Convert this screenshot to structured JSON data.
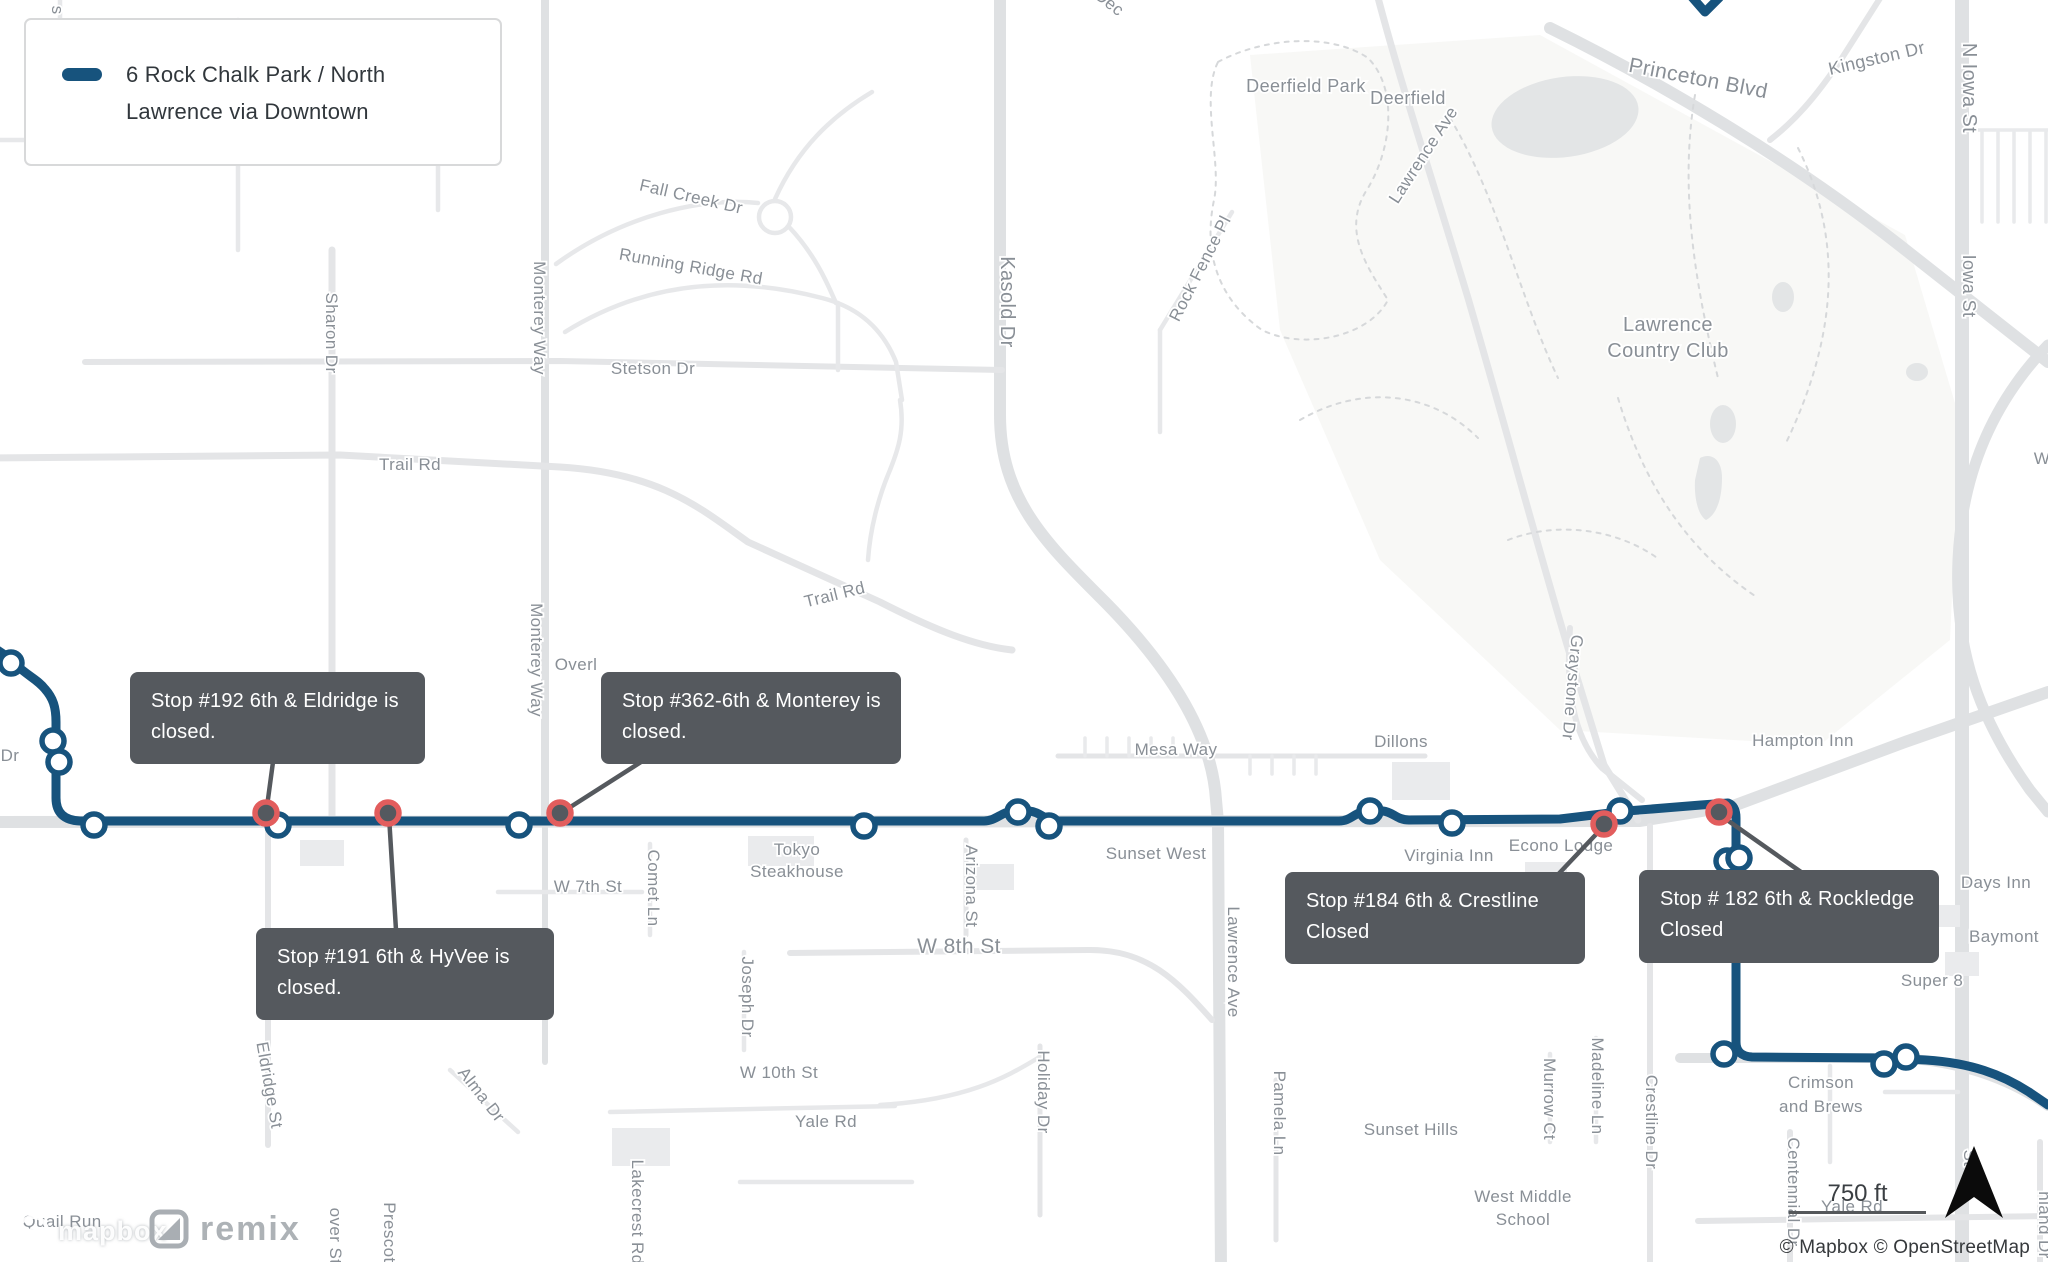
{
  "legend": {
    "line1": "6 Rock Chalk Park / North",
    "line2": "Lawrence via Downtown",
    "route_color": "#17537d"
  },
  "tooltips": [
    {
      "id": "stop-192",
      "line1": "Stop #192 6th & Eldridge is",
      "line2": "closed.",
      "leader": [
        266,
        814,
        273,
        762
      ]
    },
    {
      "id": "stop-362",
      "line1": "Stop #362-6th & Monterey is",
      "line2": "closed.",
      "leader": [
        561,
        813,
        641,
        762
      ]
    },
    {
      "id": "stop-191",
      "line1": "Stop #191 6th & HyVee is",
      "line2": "closed.",
      "leader": [
        389,
        816,
        396,
        930
      ]
    },
    {
      "id": "stop-184",
      "line1": "Stop #184 6th & Crestline",
      "line2": "Closed",
      "leader": [
        1603,
        827,
        1549,
        884
      ]
    },
    {
      "id": "stop-182",
      "line1": "Stop # 182 6th & Rockledge",
      "line2": "Closed",
      "leader": [
        1720,
        815,
        1801,
        872
      ]
    }
  ],
  "route": {
    "color": "#17537d",
    "width": 9,
    "main_path": "M -6,648 C 4,654 9,658 14,663 C 29,677 37,679 45,689 C 53,698 56,707 56,722 L 56,798 Q 56,820 80,821 L 984,821 C 996,821 1001,812 1013,811 L 1029,811 C 1041,812 1045,821 1057,821 L 1339,821 C 1351,821 1355,812 1366,811 L 1383,811 C 1393,812 1397,820 1409,820 L 1560,819 L 1627,811 L 1701,805 L 1728,803 Q 1736,806 1736,818 L 1736,1042 Q 1736,1056 1752,1057 L 1884,1058 L 1926,1060 C 1971,1063 2001,1074 2029,1092 L 2048,1105",
    "north_stub_path": "M 1691,-4 L 1705,12 L 1719,-2"
  },
  "stops": {
    "open_style": {
      "fill": "#ffffff",
      "stroke": "#17537d"
    },
    "closed_style": {
      "fill": "#54595f",
      "stroke": "#e25d5d"
    },
    "open": [
      [
        11,
        663
      ],
      [
        53,
        741
      ],
      [
        59,
        762
      ],
      [
        94,
        825
      ],
      [
        278,
        825
      ],
      [
        519,
        825
      ],
      [
        864,
        826
      ],
      [
        1018,
        812
      ],
      [
        1049,
        826
      ],
      [
        1370,
        811
      ],
      [
        1452,
        823
      ],
      [
        1620,
        811
      ],
      [
        1727,
        861
      ],
      [
        1739,
        858
      ],
      [
        1724,
        1054
      ],
      [
        1884,
        1064
      ],
      [
        1906,
        1057
      ]
    ],
    "closed": [
      [
        266,
        813
      ],
      [
        388,
        813
      ],
      [
        560,
        813
      ],
      [
        1604,
        824
      ],
      [
        1719,
        812
      ]
    ]
  },
  "map_labels": [
    {
      "text": "s F",
      "x": 52,
      "y": 18,
      "r": 90,
      "s": 17
    },
    {
      "text": "Dec",
      "x": 1106,
      "y": 7,
      "r": 38,
      "s": 17
    },
    {
      "text": "Sharon Dr",
      "x": 326,
      "y": 333,
      "r": 90,
      "s": 17
    },
    {
      "text": "Monterey Way",
      "x": 534,
      "y": 318,
      "r": 90,
      "s": 17
    },
    {
      "text": "Monterey Way",
      "x": 531,
      "y": 660,
      "r": 90,
      "s": 17
    },
    {
      "text": "Fall Creek Dr",
      "x": 690,
      "y": 202,
      "r": 13,
      "s": 17
    },
    {
      "text": "Running Ridge Rd",
      "x": 690,
      "y": 272,
      "r": 10,
      "s": 17
    },
    {
      "text": "Stetson Dr",
      "x": 653,
      "y": 374,
      "r": 0,
      "s": 17
    },
    {
      "text": "Trail Rd",
      "x": 410,
      "y": 470,
      "r": 0,
      "s": 17
    },
    {
      "text": "Trail Rd",
      "x": 836,
      "y": 600,
      "r": -14,
      "s": 17
    },
    {
      "text": "Kasold Dr",
      "x": 1001,
      "y": 302,
      "r": 90,
      "s": 20
    },
    {
      "text": "Rock Fence Pl",
      "x": 1205,
      "y": 271,
      "r": -63,
      "s": 17
    },
    {
      "text": "Deerfield Park",
      "x": 1306,
      "y": 92,
      "r": 0,
      "s": 18
    },
    {
      "text": "Deerfield",
      "x": 1408,
      "y": 104,
      "r": 0,
      "s": 18
    },
    {
      "text": "Lawrence Ave",
      "x": 1428,
      "y": 158,
      "r": -57,
      "s": 17
    },
    {
      "text": "Princeton Blvd",
      "x": 1697,
      "y": 85,
      "r": 11,
      "s": 21
    },
    {
      "text": "Kingston Dr",
      "x": 1878,
      "y": 64,
      "r": -13,
      "s": 18
    },
    {
      "text": "N Iowa St",
      "x": 1963,
      "y": 88,
      "r": 90,
      "s": 20
    },
    {
      "text": "Iowa St",
      "x": 1963,
      "y": 286,
      "r": 90,
      "s": 18
    },
    {
      "text": "Lawrence",
      "x": 1668,
      "y": 331,
      "r": 0,
      "s": 20
    },
    {
      "text": "Country Club",
      "x": 1668,
      "y": 357,
      "r": 0,
      "s": 20
    },
    {
      "text": "Graystone Dr",
      "x": 1567,
      "y": 687,
      "r": 95,
      "s": 17
    },
    {
      "text": "Hampton Inn",
      "x": 1803,
      "y": 746,
      "r": 0,
      "s": 17
    },
    {
      "text": "Overl",
      "x": 576,
      "y": 670,
      "r": 0,
      "s": 17
    },
    {
      "text": "Mesa Way",
      "x": 1176,
      "y": 755,
      "r": 0,
      "s": 17
    },
    {
      "text": "Dillons",
      "x": 1401,
      "y": 747,
      "r": 0,
      "s": 17
    },
    {
      "text": "Tokyo",
      "x": 797,
      "y": 855,
      "r": 0,
      "s": 17
    },
    {
      "text": "Steakhouse",
      "x": 797,
      "y": 877,
      "r": 0,
      "s": 17
    },
    {
      "text": "W 7th St",
      "x": 588,
      "y": 892,
      "r": 0,
      "s": 17
    },
    {
      "text": "Comet Ln",
      "x": 648,
      "y": 888,
      "r": 90,
      "s": 17
    },
    {
      "text": "Arizona St",
      "x": 966,
      "y": 886,
      "r": 90,
      "s": 17
    },
    {
      "text": "Sunset West",
      "x": 1156,
      "y": 859,
      "r": 0,
      "s": 17
    },
    {
      "text": "Virginia Inn",
      "x": 1449,
      "y": 861,
      "r": 0,
      "s": 17
    },
    {
      "text": "Econo Lodge",
      "x": 1561,
      "y": 851,
      "r": 0,
      "s": 17
    },
    {
      "text": "W 8th St",
      "x": 959,
      "y": 953,
      "r": 0,
      "s": 21
    },
    {
      "text": "Lawrence Ave",
      "x": 1228,
      "y": 962,
      "r": 90,
      "s": 17
    },
    {
      "text": "Joseph Dr",
      "x": 742,
      "y": 997,
      "r": 90,
      "s": 17
    },
    {
      "text": "Holiday Dr",
      "x": 1038,
      "y": 1092,
      "r": 90,
      "s": 17
    },
    {
      "text": "Pamela Ln",
      "x": 1274,
      "y": 1113,
      "r": 90,
      "s": 17
    },
    {
      "text": "W 10th St",
      "x": 779,
      "y": 1078,
      "r": 0,
      "s": 17
    },
    {
      "text": "Yale Rd",
      "x": 826,
      "y": 1127,
      "r": 0,
      "s": 17
    },
    {
      "text": "Days Inn",
      "x": 1996,
      "y": 888,
      "r": 0,
      "s": 17
    },
    {
      "text": "Baymont",
      "x": 2004,
      "y": 942,
      "r": 0,
      "s": 17
    },
    {
      "text": "Super 8",
      "x": 1932,
      "y": 986,
      "r": 0,
      "s": 17
    },
    {
      "text": "Crimson",
      "x": 1821,
      "y": 1088,
      "r": 0,
      "s": 17
    },
    {
      "text": "and Brews",
      "x": 1821,
      "y": 1112,
      "r": 0,
      "s": 17
    },
    {
      "text": "Sunset Hills",
      "x": 1411,
      "y": 1135,
      "r": 0,
      "s": 17
    },
    {
      "text": "Madeline Ln",
      "x": 1592,
      "y": 1086,
      "r": 90,
      "s": 17
    },
    {
      "text": "Murrow Ct",
      "x": 1544,
      "y": 1099,
      "r": 90,
      "s": 17
    },
    {
      "text": "Crestline Dr",
      "x": 1646,
      "y": 1122,
      "r": 90,
      "s": 17
    },
    {
      "text": "Eldridge St",
      "x": 264,
      "y": 1086,
      "r": 80,
      "s": 17
    },
    {
      "text": "Alma Dr",
      "x": 477,
      "y": 1098,
      "r": 52,
      "s": 17
    },
    {
      "text": "West Middle",
      "x": 1523,
      "y": 1202,
      "r": 0,
      "s": 17
    },
    {
      "text": "School",
      "x": 1523,
      "y": 1225,
      "r": 0,
      "s": 17
    },
    {
      "text": "Centennial Dr",
      "x": 1788,
      "y": 1192,
      "r": 90,
      "s": 17
    },
    {
      "text": "Yale Rd",
      "x": 1852,
      "y": 1212,
      "r": 0,
      "s": 17
    },
    {
      "text": "Quail Run",
      "x": 62,
      "y": 1227,
      "r": 0,
      "s": 17
    },
    {
      "text": "Prescott",
      "x": 384,
      "y": 1235,
      "r": 90,
      "s": 17
    },
    {
      "text": "over St",
      "x": 330,
      "y": 1236,
      "r": 90,
      "s": 17
    },
    {
      "text": "Lakecrest Rd",
      "x": 632,
      "y": 1212,
      "r": 90,
      "s": 17
    },
    {
      "text": "hland Dr",
      "x": 2039,
      "y": 1225,
      "r": 90,
      "s": 17
    },
    {
      "text": "St",
      "x": 1964,
      "y": 1158,
      "r": 90,
      "s": 17
    },
    {
      "text": "Dr",
      "x": 10,
      "y": 761,
      "r": 0,
      "s": 17
    },
    {
      "text": "W",
      "x": 2042,
      "y": 464,
      "r": 0,
      "s": 17
    }
  ],
  "controls": {
    "scale_text": "750 ft",
    "attribution": "© Mapbox © OpenStreetMap"
  },
  "logos": {
    "mapbox": "mapbox",
    "remix": "remix"
  }
}
